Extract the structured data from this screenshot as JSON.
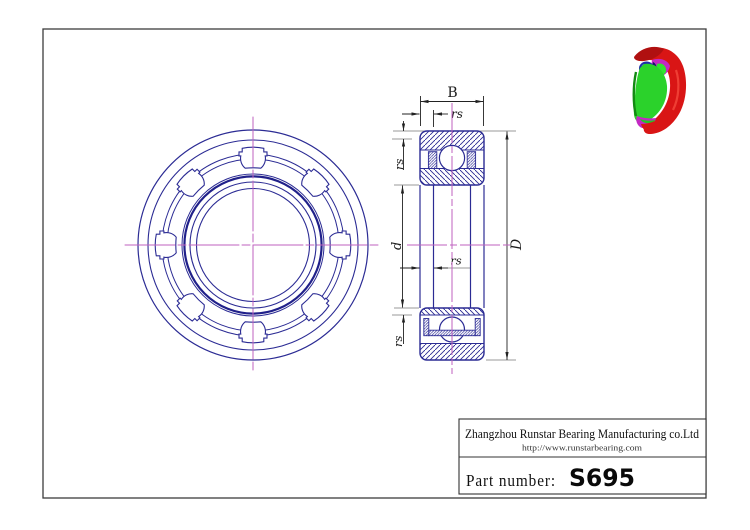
{
  "drawing": {
    "dimension_labels": {
      "width": "B",
      "chamfer": "rs",
      "bore_diameter": "d",
      "outer_diameter": "D"
    }
  },
  "title_block": {
    "company": "Zhangzhou Runstar Bearing Manufacturing co.Ltd",
    "website": "http://www.runstarbearing.com",
    "part_number_label": "Part number:",
    "part_number": "S695"
  },
  "colors": {
    "outline_navy": "#2b2b94",
    "outline_dark_navy": "#20208a",
    "centerline_magenta": "#bf62bf",
    "dimension_black": "#222222",
    "extension_gray": "#999999",
    "frame_gray": "#3c3c3c",
    "render_red": "#d91515",
    "render_green": "#2bd22b",
    "render_blue": "#1e2fa8",
    "render_magenta": "#c428c4",
    "background": "#ffffff"
  }
}
